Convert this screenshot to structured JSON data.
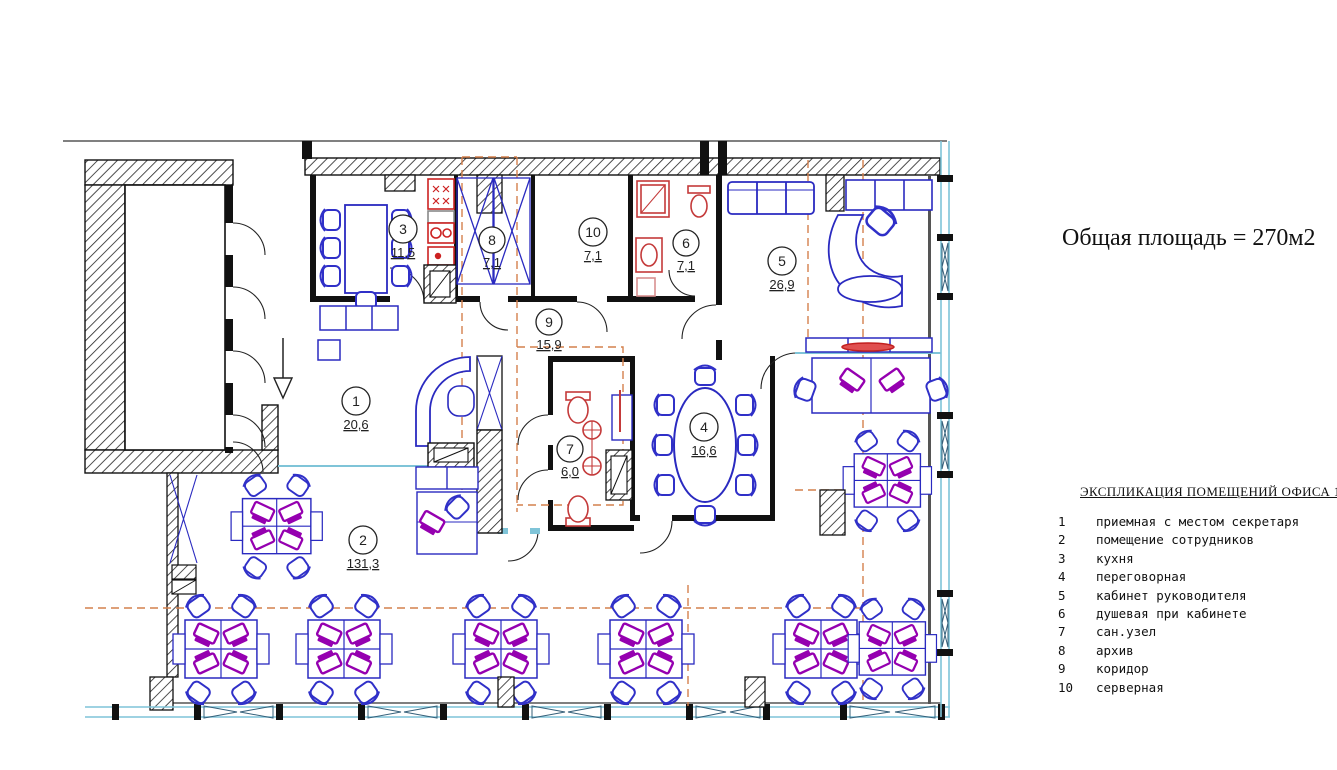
{
  "title": "Общая площадь = 270м2",
  "legend": {
    "title": "ЭКСПЛИКАЦИЯ ПОМЕЩЕНИЙ ОФИСА 1",
    "items": [
      {
        "num": "1",
        "name": "приемная с местом секретаря"
      },
      {
        "num": "2",
        "name": "помещение сотрудников"
      },
      {
        "num": "3",
        "name": "кухня"
      },
      {
        "num": "4",
        "name": "переговорная"
      },
      {
        "num": "5",
        "name": "кабинет руководителя"
      },
      {
        "num": "6",
        "name": "душевая при кабинете"
      },
      {
        "num": "7",
        "name": "сан.узел"
      },
      {
        "num": "8",
        "name": "архив"
      },
      {
        "num": "9",
        "name": "коридор"
      },
      {
        "num": "10",
        "name": "серверная"
      }
    ]
  },
  "rooms": [
    {
      "number": "1",
      "area": "20,6"
    },
    {
      "number": "2",
      "area": "131,3"
    },
    {
      "number": "3",
      "area": "11,5"
    },
    {
      "number": "4",
      "area": "16,6"
    },
    {
      "number": "5",
      "area": "26,9"
    },
    {
      "number": "6",
      "area": "7,1"
    },
    {
      "number": "7",
      "area": "6,0"
    },
    {
      "number": "8",
      "area": "7,1"
    },
    {
      "number": "9",
      "area": "15,9"
    },
    {
      "number": "10",
      "area": "7,1"
    }
  ],
  "colors": {
    "wall": "#111111",
    "furniture_blue": "#2a2ac0",
    "equipment_purple": "#9500b0",
    "sanitary_red": "#c43a3a",
    "glazing_cyan": "#7fc4d8",
    "axis_orange": "#d4804d"
  }
}
